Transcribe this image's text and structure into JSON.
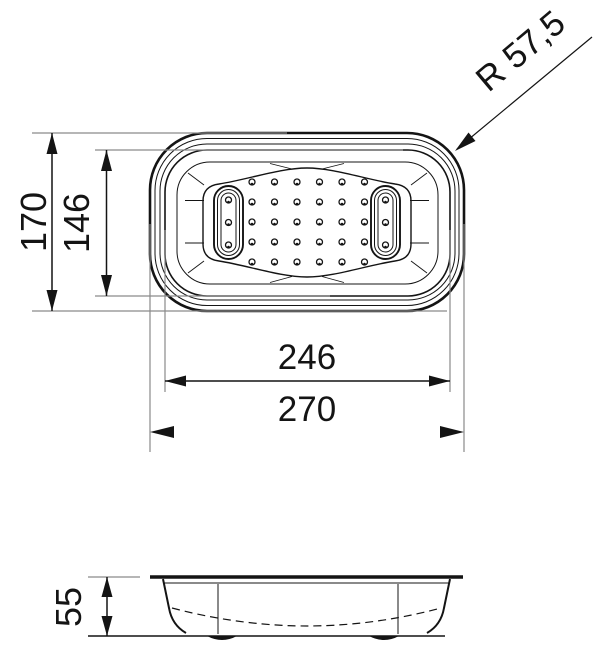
{
  "canvas": {
    "width": 600,
    "height": 645,
    "background": "#ffffff"
  },
  "style": {
    "line_color": "#141414",
    "extension_line_color": "#8a8a8a",
    "text_color": "#141414"
  },
  "dimensions": {
    "outer_length": "270",
    "inner_length": "246",
    "outer_width": "170",
    "inner_width": "146",
    "corner_radius": "R 57,5",
    "height": "55"
  },
  "top_view": {
    "perforation_rows": 5,
    "perforation_columns": 6,
    "handles": 2,
    "holes_per_handle": 3
  }
}
